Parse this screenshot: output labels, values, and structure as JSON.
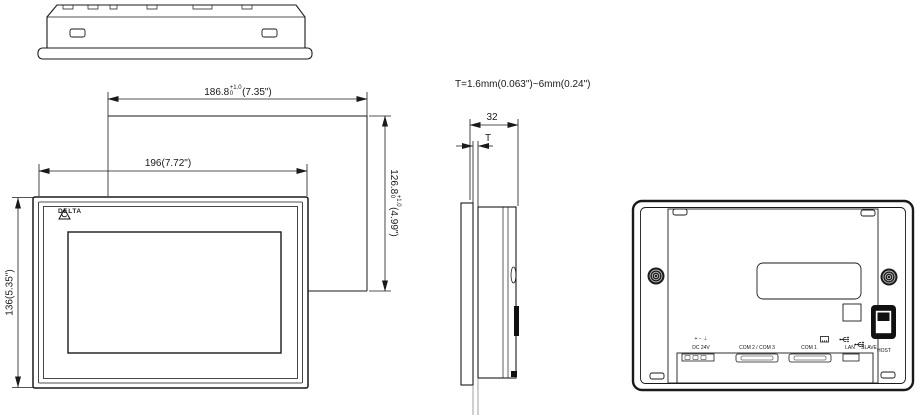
{
  "drawing": {
    "brand": "DELTA",
    "note_thickness": "T=1.6mm(0.063\")~6mm(0.24\")"
  },
  "dimensions": {
    "front_width": "196(7.72\")",
    "front_height": "136(5.35\")",
    "depth": "32",
    "panel_thickness": "T",
    "cutout_width": {
      "value": "186.8",
      "tol_upper": "+1.0",
      "tol_lower": "0",
      "inches": "(7.35\")"
    },
    "cutout_height": {
      "value": "126.8",
      "tol_upper": "+1.0",
      "tol_lower": "0",
      "inches": "(4.99\")"
    }
  },
  "rear_ports": {
    "power_symbols": "+ − ⊥",
    "power_label": "DC 24V",
    "com23_label": "COM 2 / COM 3",
    "com1_label": "COM 1",
    "lan_label": "LAN",
    "slave_label": "SLAVE",
    "host_label": "HOST"
  }
}
